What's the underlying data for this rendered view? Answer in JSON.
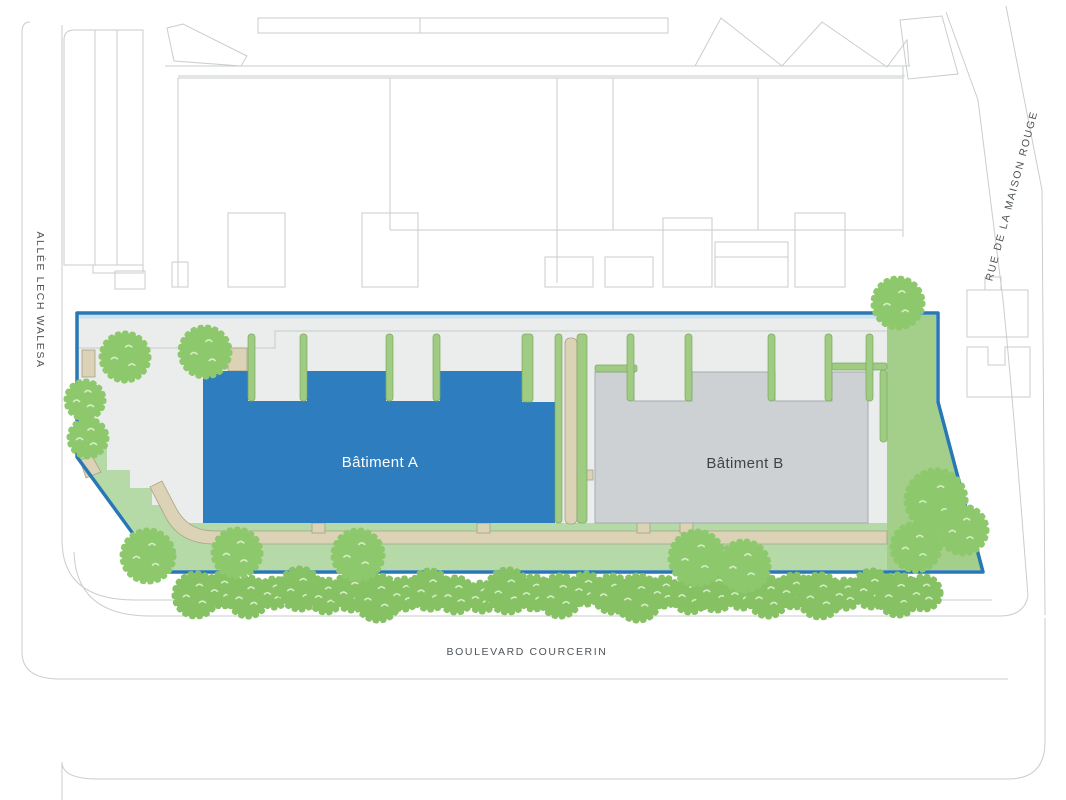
{
  "labels": {
    "street_left": "ALLÉE LECH WALESA",
    "street_right": "RUE DE LA MAISON ROUGE",
    "street_bottom": "BOULEVARD COURCERIN"
  },
  "buildings": {
    "a": {
      "label": "Bâtiment A"
    },
    "b": {
      "label": "Bâtiment B"
    }
  },
  "colors": {
    "boundary": "#2878b4",
    "building_a": "#2e7dbe",
    "building_a_label": "#ffffff",
    "building_b": "#ced1d3",
    "building_b_stroke": "#a6abaf",
    "building_b_label": "#3f4448",
    "plinth": "#ebedec",
    "green_light": "#b5d9a7",
    "green_medium": "#a3cf8a",
    "strip_green": "#9fcb83",
    "tan_path": "#dcd2b6",
    "tree": "#8dc96c",
    "hedge": "#86c163",
    "tree_speckle": "#d4eec3",
    "context_line": "#c9cdcc",
    "label_text": "#4e5357",
    "top_strip": "#c8e0f0"
  },
  "map": {
    "trees": [
      {
        "x": 125,
        "y": 357,
        "r": 24
      },
      {
        "x": 205,
        "y": 352,
        "r": 25
      },
      {
        "x": 85,
        "y": 400,
        "r": 19
      },
      {
        "x": 88,
        "y": 438,
        "r": 19
      },
      {
        "x": 148,
        "y": 556,
        "r": 26
      },
      {
        "x": 237,
        "y": 553,
        "r": 24
      },
      {
        "x": 358,
        "y": 555,
        "r": 25
      },
      {
        "x": 697,
        "y": 558,
        "r": 27
      },
      {
        "x": 744,
        "y": 566,
        "r": 25
      },
      {
        "x": 898,
        "y": 303,
        "r": 25
      },
      {
        "x": 936,
        "y": 500,
        "r": 30
      },
      {
        "x": 963,
        "y": 530,
        "r": 24
      },
      {
        "x": 916,
        "y": 547,
        "r": 24
      }
    ],
    "hedge_row": {
      "x_start": 196,
      "step": 26,
      "count": 29,
      "y_base": 593,
      "dy": [
        2,
        -3,
        4,
        0,
        -4,
        3,
        -1,
        5,
        1,
        -3,
        2,
        4,
        -2,
        0,
        3,
        -4,
        1,
        5,
        -1,
        2,
        -3,
        0,
        4,
        -2,
        3,
        1,
        -4,
        2,
        0
      ],
      "radii": [
        22,
        17,
        20,
        15,
        21,
        17,
        19,
        23,
        16,
        20,
        18,
        15,
        22,
        17,
        21,
        16,
        19,
        23,
        15,
        18,
        21,
        16,
        20,
        17,
        22,
        15,
        19,
        21,
        17
      ]
    }
  }
}
